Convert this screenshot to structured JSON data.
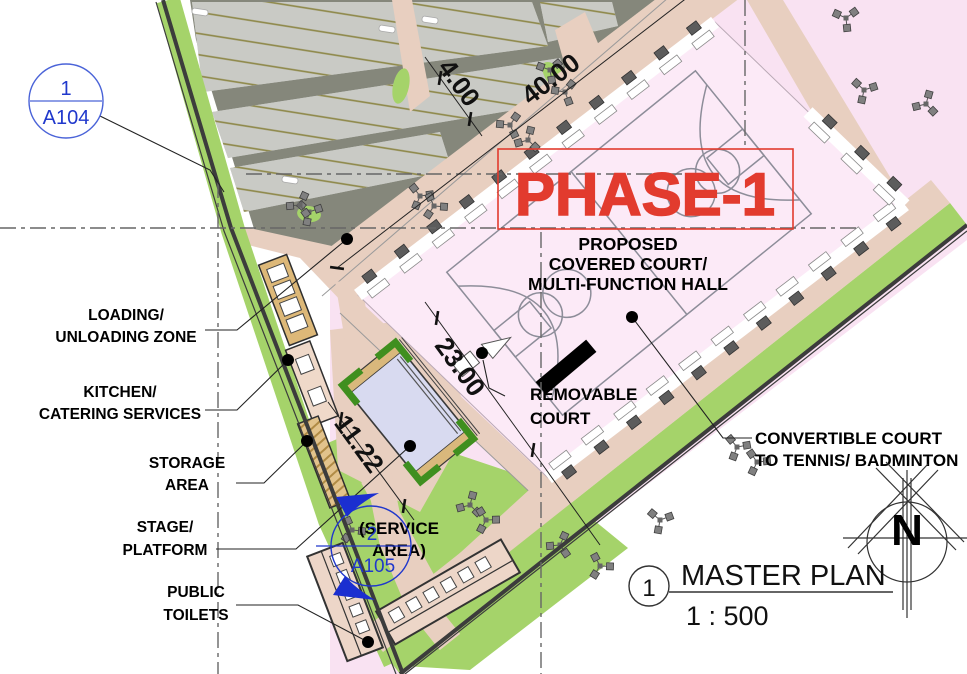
{
  "drawing": {
    "phase_banner": "PHASE-1",
    "court_title": [
      "PROPOSED",
      "COVERED COURT/",
      "MULTI-FUNCTION HALL"
    ],
    "labels": {
      "loading": [
        "LOADING/",
        "UNLOADING ZONE"
      ],
      "kitchen": [
        "KITCHEN/",
        "CATERING SERVICES"
      ],
      "storage": [
        "STORAGE",
        "AREA"
      ],
      "stage": [
        "STAGE/",
        "PLATFORM"
      ],
      "toilets": [
        "PUBLIC",
        "TOILETS"
      ],
      "removable": [
        "REMOVABLE",
        "COURT"
      ],
      "convertible": [
        "CONVERTIBLE COURT",
        "TO TENNIS/ BADMINTON"
      ],
      "service": [
        "(SERVICE",
        "AREA)"
      ]
    },
    "dimensions": {
      "road_width": "4.00",
      "road_length": "40.00",
      "court_width": "23.00",
      "stage_length": "11.22"
    },
    "callouts": {
      "a104": {
        "number": "1",
        "sheet": "A104"
      },
      "a105": {
        "number": "2",
        "sheet": "A105"
      }
    },
    "titleblock": {
      "number": "1",
      "title": "MASTER PLAN",
      "scale": "1 : 500"
    },
    "north_letter": "N",
    "colors": {
      "accent_red": "#e23b2e",
      "callout_blue": "#2038cc",
      "lawn_green": "#a5d36a",
      "bright_green": "#3f8f1f",
      "walkway_tan": "#e8cfc0",
      "court_pink": "#fceaf7",
      "outer_pink": "#f9e2f2",
      "parking_dark": "#85877b",
      "stall_gray": "#c9cac5",
      "stall_stripe": "#8d8747",
      "stage_lavender": "#d8daf0",
      "building_tan": "#ddb878"
    }
  }
}
